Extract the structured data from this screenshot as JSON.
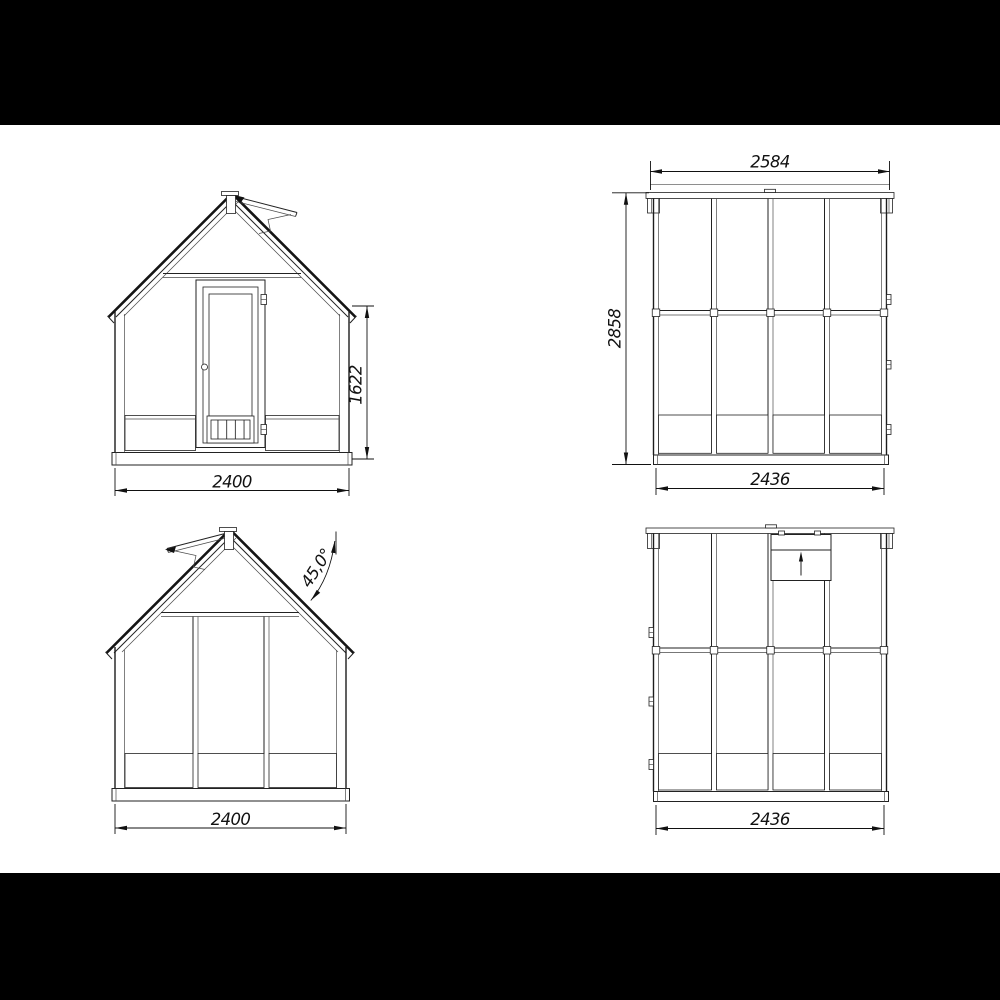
{
  "colors": {
    "backdrop": "#000000",
    "paper": "#ffffff",
    "ink": "#1a1a1a"
  },
  "views": {
    "front": {
      "width": "2400",
      "wall_height": "1622"
    },
    "side_right": {
      "roof_length": "2584",
      "overall_height": "2858",
      "wall_length": "2436"
    },
    "rear": {
      "width": "2400",
      "roof_angle": "45,0°"
    },
    "side_left": {
      "wall_length": "2436"
    }
  }
}
